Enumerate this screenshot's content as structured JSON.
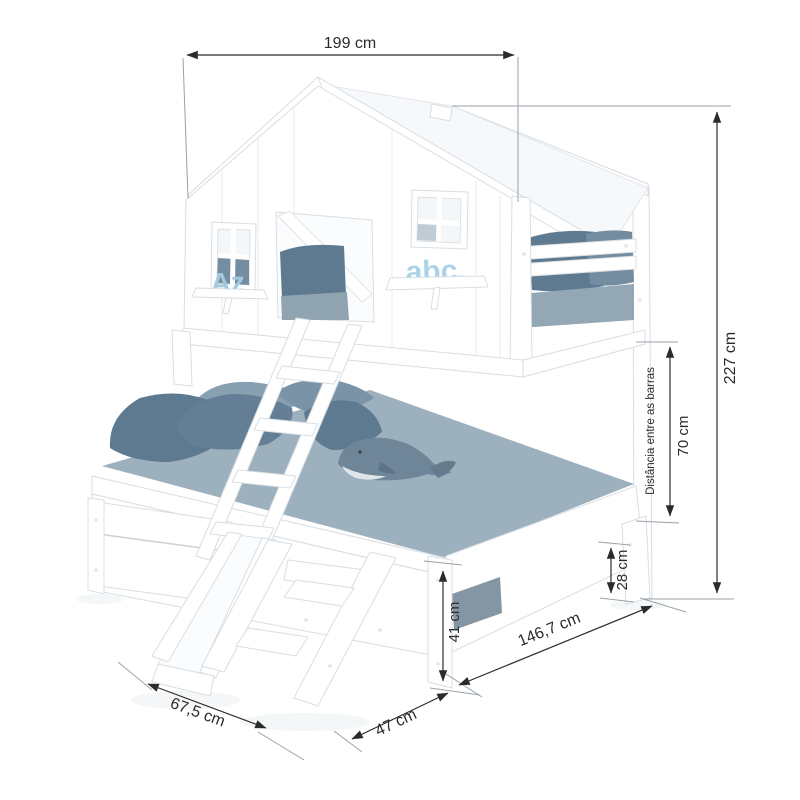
{
  "annotations": {
    "top_width": "199 cm",
    "total_height": "227 cm",
    "bars_distance_label": "Distância entre as barras",
    "bars_distance": "70 cm",
    "base_height": "41 cm",
    "leg_clearance": "28 cm",
    "depth": "146,7 cm",
    "stairs_depth": "47 cm",
    "slide_length": "67,5 cm"
  },
  "decor": {
    "left_window_letters": "Az",
    "right_window_letters": "abc."
  },
  "colors": {
    "background": "#ffffff",
    "dimension_line": "#2b2b2b",
    "witness_line": "#9aa2a9",
    "wood": "#ffffff",
    "wood_outline": "#d8dee3",
    "mattress": "#9db0be",
    "sheet": "#8fa3b1",
    "pillow_dark": "#5d7a91",
    "pillow_light": "#87a0b2",
    "stripe_dark": "#8496a3",
    "letters_blue": "#a6cde2"
  }
}
